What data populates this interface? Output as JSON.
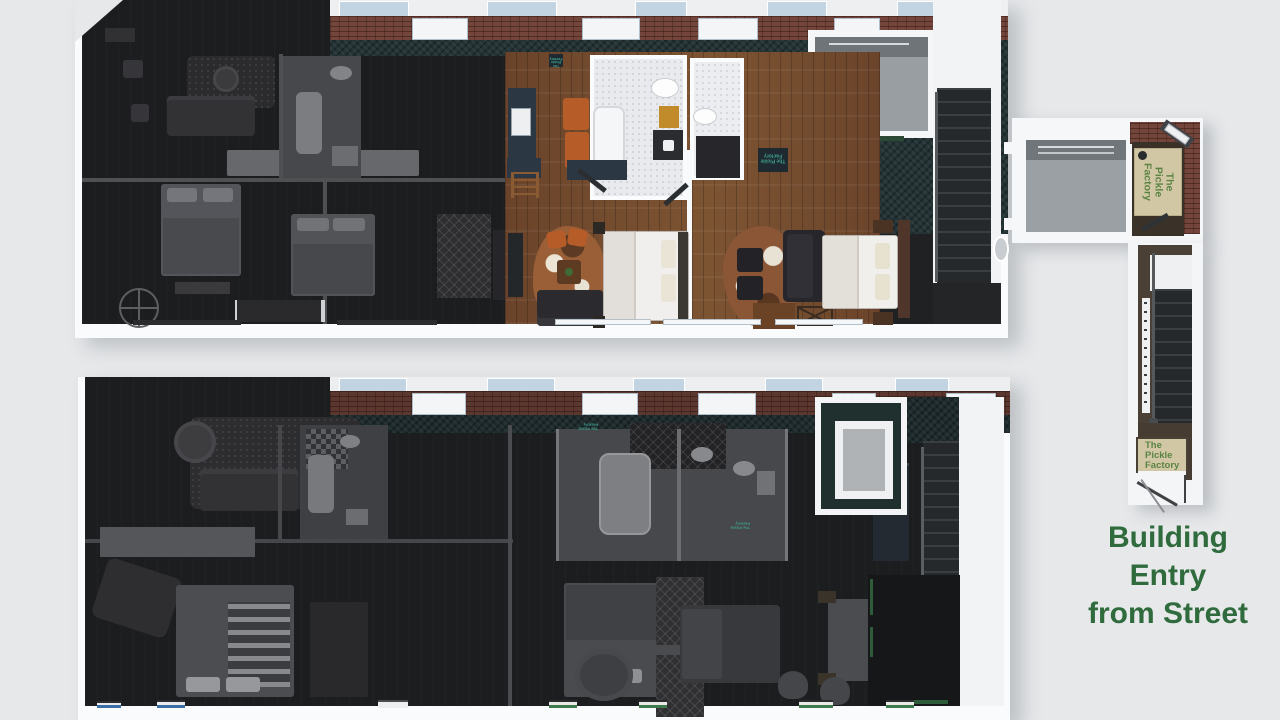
{
  "caption": {
    "lines": [
      "Building",
      "Entry",
      "from Street"
    ],
    "color": "#2f6b3d"
  },
  "mats": {
    "vestibule": {
      "lines": [
        "The",
        "Pickle",
        "Factory"
      ]
    },
    "street": {
      "lines": [
        "The",
        "Pickle",
        "Factory"
      ]
    },
    "small_doormat_text": "The Pickle Factory"
  },
  "building": {
    "name_on_mats": "The Pickle Factory"
  },
  "palette": {
    "background": "#e6e8ea",
    "caption_green": "#2f6b3d",
    "mat_cream": "#d2c7a4",
    "mat_text_green": "#5a8444",
    "wood_floor": "#70492c",
    "courtyard_teal": "#243335",
    "brick": "#73453b",
    "dark_interior": "#1c1d1f",
    "stair_carpet": "#2a2e30",
    "terrace_gray": "#9aa0a3",
    "kitchen_navy": "#2b3743",
    "chair_orange": "#b65c28",
    "cabinet_yellow": "#c18a2a",
    "skylight_blue": "#c2d4e1",
    "window_mark_green": "#3e7a4b",
    "window_mark_blue": "#3a6ea5"
  }
}
